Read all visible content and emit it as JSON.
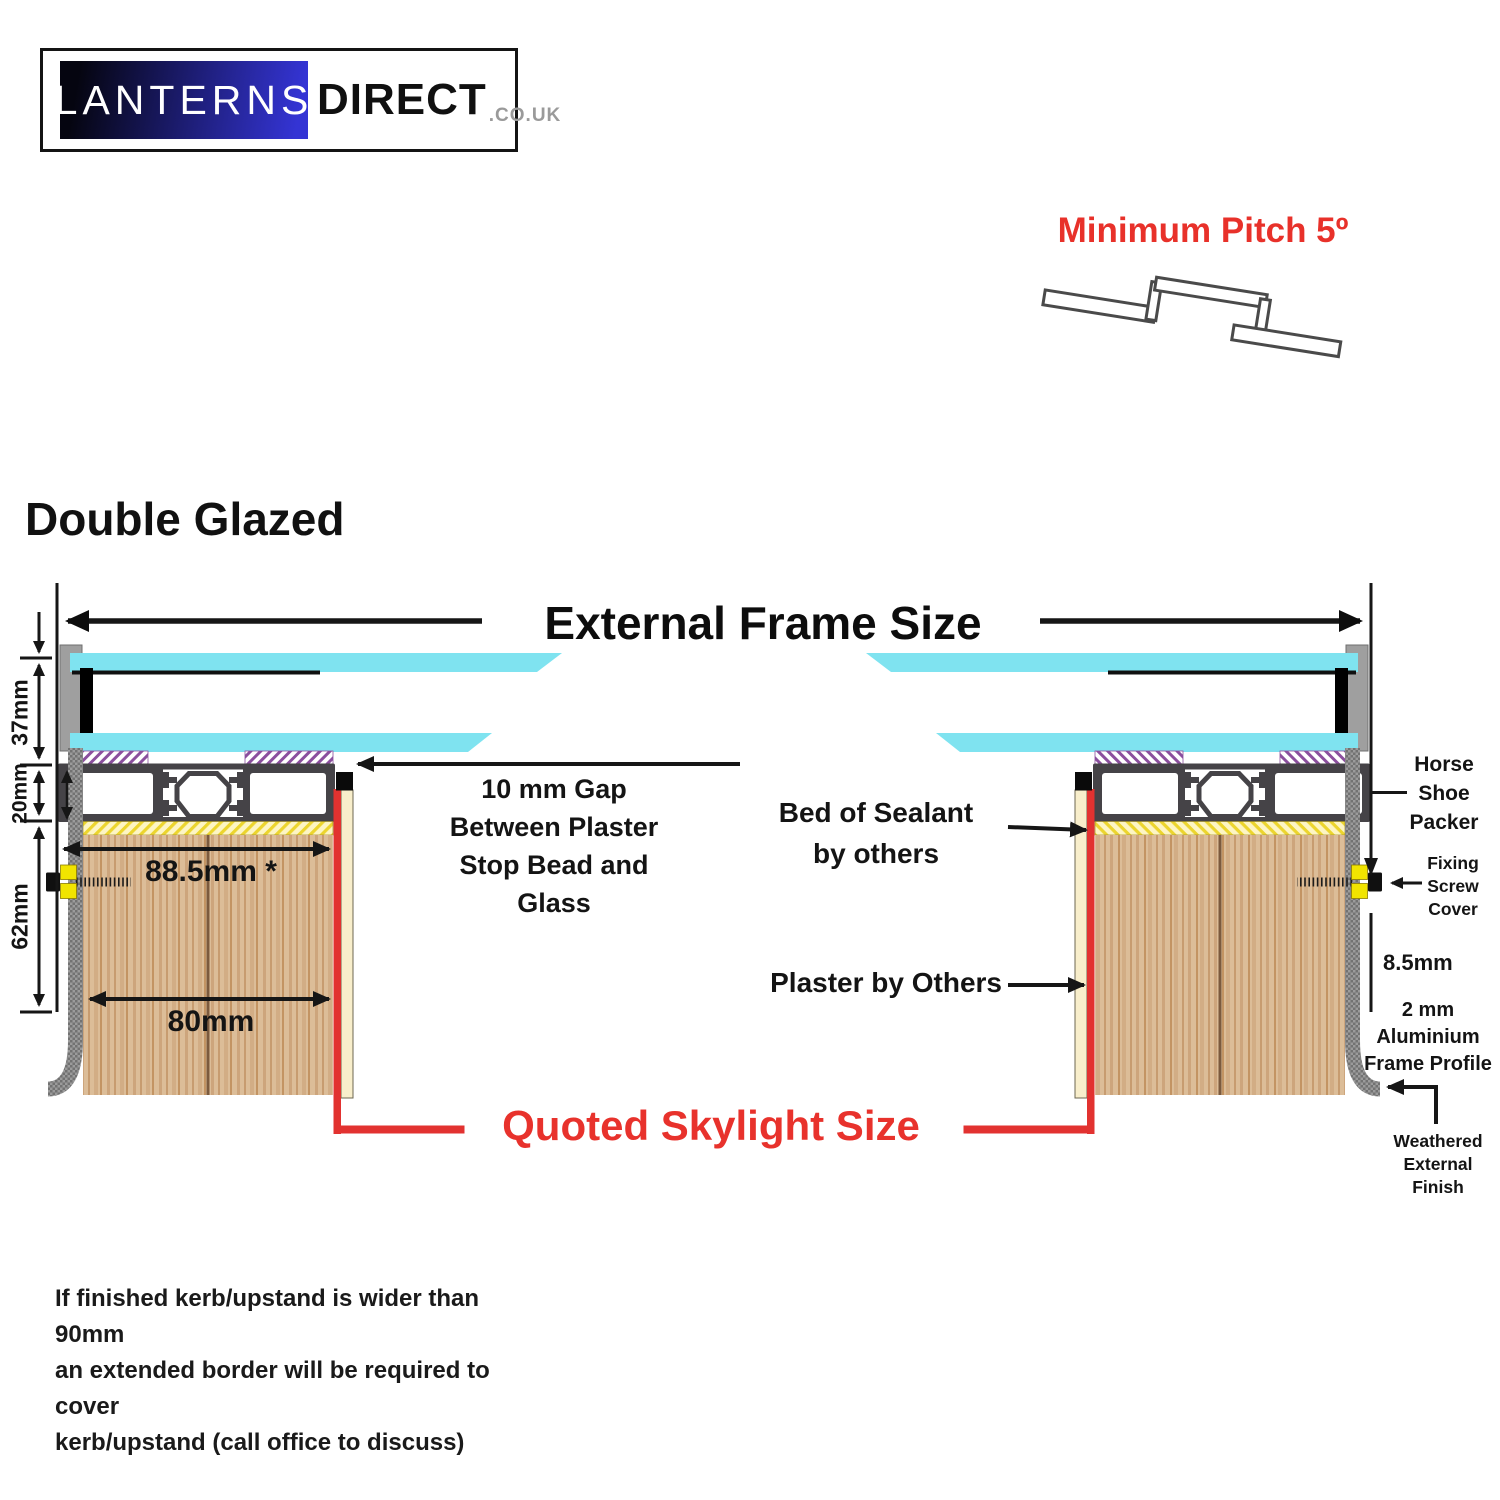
{
  "logo": {
    "lanterns": "LANTERNS",
    "direct": "DIRECT",
    "suffix": ".co.uk"
  },
  "pitch": {
    "label": "Minimum Pitch 5º"
  },
  "title": {
    "double_glazed": "Double Glazed"
  },
  "frame": {
    "external_label": "External Frame Size",
    "quoted_label": "Quoted Skylight Size"
  },
  "dims": {
    "d37": "37mm",
    "d20": "20mm",
    "d62": "62mm",
    "d885": "88.5mm *",
    "d80": "80mm",
    "d85": "8.5mm"
  },
  "labels": {
    "gap": [
      "10 mm Gap",
      "Between Plaster",
      "Stop Bead and",
      "Glass"
    ],
    "bed": [
      "Bed of Sealant",
      "by others"
    ],
    "plaster": "Plaster by Others",
    "horse": [
      "Horse",
      "Shoe",
      "Packer"
    ],
    "fixing": [
      "Fixing",
      "Screw",
      "Cover"
    ],
    "alu": [
      "2 mm",
      "Aluminium",
      "Frame Profile"
    ],
    "weathered": [
      "Weathered",
      "External",
      "Finish"
    ]
  },
  "note": {
    "lines": [
      "If finished kerb/upstand is wider than 90mm",
      "an extended border will be required to cover",
      "kerb/upstand (call office to discuss)"
    ]
  },
  "colors": {
    "accent_red": "#e8312a",
    "glass_cyan": "#7fe3f0",
    "profile_dark": "#454347",
    "wood_base": "#dcbd98",
    "sealant_yellow": "#f0d93a",
    "purple_gasket": "#8b4f9e",
    "packer_yellow": "#f1e400",
    "logo_blue": "#3434d4",
    "outer_gray": "#969696"
  }
}
